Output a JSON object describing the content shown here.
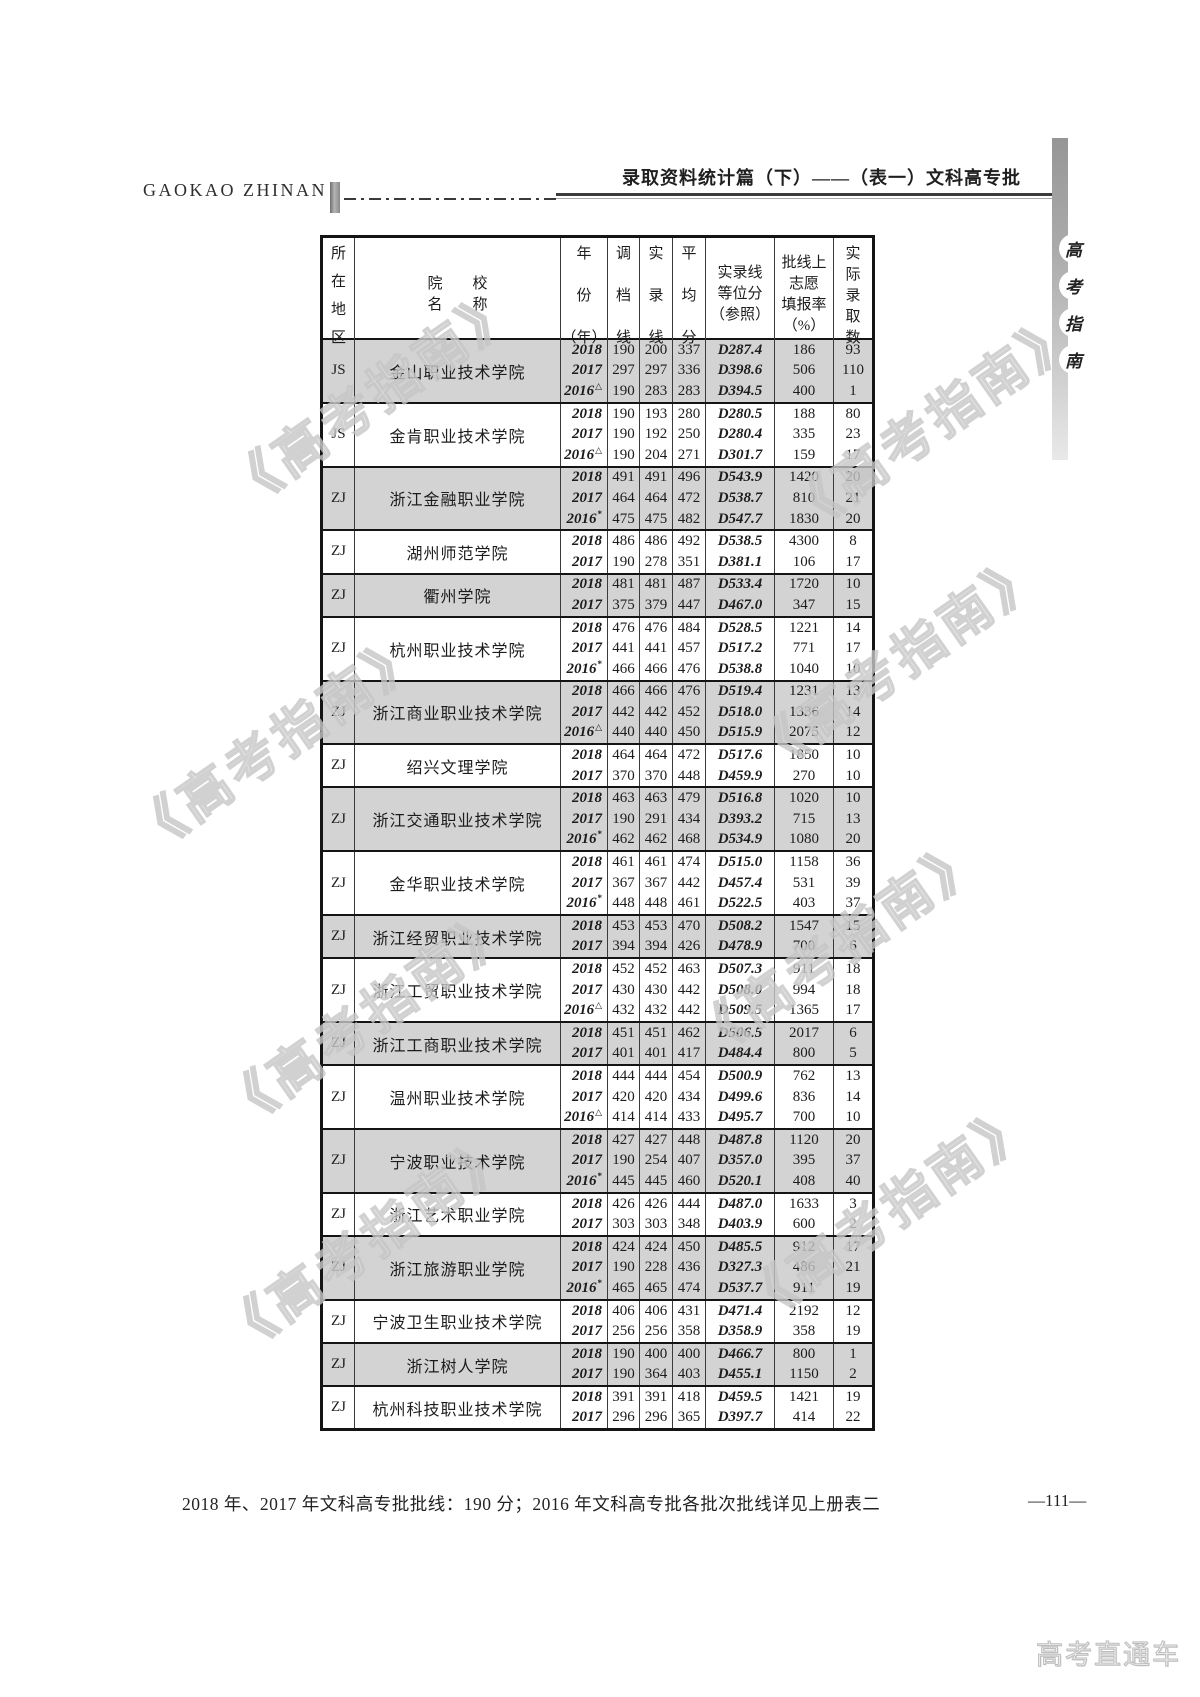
{
  "page": {
    "brand": "GAOKAO ZHINAN",
    "header_title": "录取资料统计篇（下）——（表一）文科高专批",
    "sidebar_label_chars": [
      "高",
      "考",
      "指",
      "南"
    ],
    "watermark_text": "《高考指南》",
    "footer_note": "2018 年、2017 年文科高专批批线：190 分；2016 年文科高专批各批次批线详见上册表二",
    "page_number": "—111—",
    "corner_watermark": "高考直通车"
  },
  "colors": {
    "row_shade": "#d3d3d3",
    "ink": "#1c1c1c",
    "watermark": "#c6c6c6"
  },
  "table": {
    "header": {
      "region_lines": [
        "所",
        "在",
        "地",
        "区"
      ],
      "college_lines": [
        "院　　校",
        "名　　称"
      ],
      "year_lines": [
        "年",
        "份",
        "（年）"
      ],
      "diaodang_lines": [
        "调",
        "档",
        "线"
      ],
      "shilu_lines": [
        "实",
        "录",
        "线"
      ],
      "pingjun_lines": [
        "平",
        "均",
        "分"
      ],
      "dengwei_lines": [
        "实录线",
        "等位分",
        "（参照）"
      ],
      "tianbao_lines": [
        "批线上",
        "志愿",
        "填报率",
        "（%）"
      ],
      "luqu_lines": [
        "实",
        "际",
        "录",
        "取",
        "数"
      ]
    },
    "groups": [
      {
        "region": "JS",
        "college": "金山职业技术学院",
        "shaded": true,
        "rows": [
          {
            "year": "2018",
            "sup": "",
            "diaodang": "190",
            "shilu": "200",
            "pingjun": "337",
            "dengwei": "D287.4",
            "tianbao": "186",
            "luqu": "93"
          },
          {
            "year": "2017",
            "sup": "",
            "diaodang": "297",
            "shilu": "297",
            "pingjun": "336",
            "dengwei": "D398.6",
            "tianbao": "506",
            "luqu": "110"
          },
          {
            "year": "2016",
            "sup": "△",
            "diaodang": "190",
            "shilu": "283",
            "pingjun": "283",
            "dengwei": "D394.5",
            "tianbao": "400",
            "luqu": "1"
          }
        ]
      },
      {
        "region": "JS",
        "college": "金肯职业技术学院",
        "shaded": false,
        "rows": [
          {
            "year": "2018",
            "sup": "",
            "diaodang": "190",
            "shilu": "193",
            "pingjun": "280",
            "dengwei": "D280.5",
            "tianbao": "188",
            "luqu": "80"
          },
          {
            "year": "2017",
            "sup": "",
            "diaodang": "190",
            "shilu": "192",
            "pingjun": "250",
            "dengwei": "D280.4",
            "tianbao": "335",
            "luqu": "23"
          },
          {
            "year": "2016",
            "sup": "△",
            "diaodang": "190",
            "shilu": "204",
            "pingjun": "271",
            "dengwei": "D301.7",
            "tianbao": "159",
            "luqu": "17"
          }
        ]
      },
      {
        "region": "ZJ",
        "college": "浙江金融职业学院",
        "shaded": true,
        "rows": [
          {
            "year": "2018",
            "sup": "",
            "diaodang": "491",
            "shilu": "491",
            "pingjun": "496",
            "dengwei": "D543.9",
            "tianbao": "1420",
            "luqu": "20"
          },
          {
            "year": "2017",
            "sup": "",
            "diaodang": "464",
            "shilu": "464",
            "pingjun": "472",
            "dengwei": "D538.7",
            "tianbao": "810",
            "luqu": "21"
          },
          {
            "year": "2016",
            "sup": "*",
            "diaodang": "475",
            "shilu": "475",
            "pingjun": "482",
            "dengwei": "D547.7",
            "tianbao": "1830",
            "luqu": "20"
          }
        ]
      },
      {
        "region": "ZJ",
        "college": "湖州师范学院",
        "shaded": false,
        "rows": [
          {
            "year": "2018",
            "sup": "",
            "diaodang": "486",
            "shilu": "486",
            "pingjun": "492",
            "dengwei": "D538.5",
            "tianbao": "4300",
            "luqu": "8"
          },
          {
            "year": "2017",
            "sup": "",
            "diaodang": "190",
            "shilu": "278",
            "pingjun": "351",
            "dengwei": "D381.1",
            "tianbao": "106",
            "luqu": "17"
          }
        ]
      },
      {
        "region": "ZJ",
        "college": "衢州学院",
        "shaded": true,
        "rows": [
          {
            "year": "2018",
            "sup": "",
            "diaodang": "481",
            "shilu": "481",
            "pingjun": "487",
            "dengwei": "D533.4",
            "tianbao": "1720",
            "luqu": "10"
          },
          {
            "year": "2017",
            "sup": "",
            "diaodang": "375",
            "shilu": "379",
            "pingjun": "447",
            "dengwei": "D467.0",
            "tianbao": "347",
            "luqu": "15"
          }
        ]
      },
      {
        "region": "ZJ",
        "college": "杭州职业技术学院",
        "shaded": false,
        "rows": [
          {
            "year": "2018",
            "sup": "",
            "diaodang": "476",
            "shilu": "476",
            "pingjun": "484",
            "dengwei": "D528.5",
            "tianbao": "1221",
            "luqu": "14"
          },
          {
            "year": "2017",
            "sup": "",
            "diaodang": "441",
            "shilu": "441",
            "pingjun": "457",
            "dengwei": "D517.2",
            "tianbao": "771",
            "luqu": "17"
          },
          {
            "year": "2016",
            "sup": "*",
            "diaodang": "466",
            "shilu": "466",
            "pingjun": "476",
            "dengwei": "D538.8",
            "tianbao": "1040",
            "luqu": "10"
          }
        ]
      },
      {
        "region": "ZJ",
        "college": "浙江商业职业技术学院",
        "shaded": true,
        "rows": [
          {
            "year": "2018",
            "sup": "",
            "diaodang": "466",
            "shilu": "466",
            "pingjun": "476",
            "dengwei": "D519.4",
            "tianbao": "1231",
            "luqu": "13"
          },
          {
            "year": "2017",
            "sup": "",
            "diaodang": "442",
            "shilu": "442",
            "pingjun": "452",
            "dengwei": "D518.0",
            "tianbao": "1336",
            "luqu": "14"
          },
          {
            "year": "2016",
            "sup": "△",
            "diaodang": "440",
            "shilu": "440",
            "pingjun": "450",
            "dengwei": "D515.9",
            "tianbao": "2075",
            "luqu": "12"
          }
        ]
      },
      {
        "region": "ZJ",
        "college": "绍兴文理学院",
        "shaded": false,
        "rows": [
          {
            "year": "2018",
            "sup": "",
            "diaodang": "464",
            "shilu": "464",
            "pingjun": "472",
            "dengwei": "D517.6",
            "tianbao": "1850",
            "luqu": "10"
          },
          {
            "year": "2017",
            "sup": "",
            "diaodang": "370",
            "shilu": "370",
            "pingjun": "448",
            "dengwei": "D459.9",
            "tianbao": "270",
            "luqu": "10"
          }
        ]
      },
      {
        "region": "ZJ",
        "college": "浙江交通职业技术学院",
        "shaded": true,
        "rows": [
          {
            "year": "2018",
            "sup": "",
            "diaodang": "463",
            "shilu": "463",
            "pingjun": "479",
            "dengwei": "D516.8",
            "tianbao": "1020",
            "luqu": "10"
          },
          {
            "year": "2017",
            "sup": "",
            "diaodang": "190",
            "shilu": "291",
            "pingjun": "434",
            "dengwei": "D393.2",
            "tianbao": "715",
            "luqu": "13"
          },
          {
            "year": "2016",
            "sup": "*",
            "diaodang": "462",
            "shilu": "462",
            "pingjun": "468",
            "dengwei": "D534.9",
            "tianbao": "1080",
            "luqu": "20"
          }
        ]
      },
      {
        "region": "ZJ",
        "college": "金华职业技术学院",
        "shaded": false,
        "rows": [
          {
            "year": "2018",
            "sup": "",
            "diaodang": "461",
            "shilu": "461",
            "pingjun": "474",
            "dengwei": "D515.0",
            "tianbao": "1158",
            "luqu": "36"
          },
          {
            "year": "2017",
            "sup": "",
            "diaodang": "367",
            "shilu": "367",
            "pingjun": "442",
            "dengwei": "D457.4",
            "tianbao": "531",
            "luqu": "39"
          },
          {
            "year": "2016",
            "sup": "*",
            "diaodang": "448",
            "shilu": "448",
            "pingjun": "461",
            "dengwei": "D522.5",
            "tianbao": "403",
            "luqu": "37"
          }
        ]
      },
      {
        "region": "ZJ",
        "college": "浙江经贸职业技术学院",
        "shaded": true,
        "rows": [
          {
            "year": "2018",
            "sup": "",
            "diaodang": "453",
            "shilu": "453",
            "pingjun": "470",
            "dengwei": "D508.2",
            "tianbao": "1547",
            "luqu": "15"
          },
          {
            "year": "2017",
            "sup": "",
            "diaodang": "394",
            "shilu": "394",
            "pingjun": "426",
            "dengwei": "D478.9",
            "tianbao": "700",
            "luqu": "6"
          }
        ]
      },
      {
        "region": "ZJ",
        "college": "浙江工贸职业技术学院",
        "shaded": false,
        "rows": [
          {
            "year": "2018",
            "sup": "",
            "diaodang": "452",
            "shilu": "452",
            "pingjun": "463",
            "dengwei": "D507.3",
            "tianbao": "911",
            "luqu": "18"
          },
          {
            "year": "2017",
            "sup": "",
            "diaodang": "430",
            "shilu": "430",
            "pingjun": "442",
            "dengwei": "D508.0",
            "tianbao": "994",
            "luqu": "18"
          },
          {
            "year": "2016",
            "sup": "△",
            "diaodang": "432",
            "shilu": "432",
            "pingjun": "442",
            "dengwei": "D509.5",
            "tianbao": "1365",
            "luqu": "17"
          }
        ]
      },
      {
        "region": "ZJ",
        "college": "浙江工商职业技术学院",
        "shaded": true,
        "rows": [
          {
            "year": "2018",
            "sup": "",
            "diaodang": "451",
            "shilu": "451",
            "pingjun": "462",
            "dengwei": "D506.5",
            "tianbao": "2017",
            "luqu": "6"
          },
          {
            "year": "2017",
            "sup": "",
            "diaodang": "401",
            "shilu": "401",
            "pingjun": "417",
            "dengwei": "D484.4",
            "tianbao": "800",
            "luqu": "5"
          }
        ]
      },
      {
        "region": "ZJ",
        "college": "温州职业技术学院",
        "shaded": false,
        "rows": [
          {
            "year": "2018",
            "sup": "",
            "diaodang": "444",
            "shilu": "444",
            "pingjun": "454",
            "dengwei": "D500.9",
            "tianbao": "762",
            "luqu": "13"
          },
          {
            "year": "2017",
            "sup": "",
            "diaodang": "420",
            "shilu": "420",
            "pingjun": "434",
            "dengwei": "D499.6",
            "tianbao": "836",
            "luqu": "14"
          },
          {
            "year": "2016",
            "sup": "△",
            "diaodang": "414",
            "shilu": "414",
            "pingjun": "433",
            "dengwei": "D495.7",
            "tianbao": "700",
            "luqu": "10"
          }
        ]
      },
      {
        "region": "ZJ",
        "college": "宁波职业技术学院",
        "shaded": true,
        "rows": [
          {
            "year": "2018",
            "sup": "",
            "diaodang": "427",
            "shilu": "427",
            "pingjun": "448",
            "dengwei": "D487.8",
            "tianbao": "1120",
            "luqu": "20"
          },
          {
            "year": "2017",
            "sup": "",
            "diaodang": "190",
            "shilu": "254",
            "pingjun": "407",
            "dengwei": "D357.0",
            "tianbao": "395",
            "luqu": "37"
          },
          {
            "year": "2016",
            "sup": "*",
            "diaodang": "445",
            "shilu": "445",
            "pingjun": "460",
            "dengwei": "D520.1",
            "tianbao": "408",
            "luqu": "40"
          }
        ]
      },
      {
        "region": "ZJ",
        "college": "浙江艺术职业学院",
        "shaded": false,
        "rows": [
          {
            "year": "2018",
            "sup": "",
            "diaodang": "426",
            "shilu": "426",
            "pingjun": "444",
            "dengwei": "D487.0",
            "tianbao": "1633",
            "luqu": "3"
          },
          {
            "year": "2017",
            "sup": "",
            "diaodang": "303",
            "shilu": "303",
            "pingjun": "348",
            "dengwei": "D403.9",
            "tianbao": "600",
            "luqu": "2"
          }
        ]
      },
      {
        "region": "ZJ",
        "college": "浙江旅游职业学院",
        "shaded": true,
        "rows": [
          {
            "year": "2018",
            "sup": "",
            "diaodang": "424",
            "shilu": "424",
            "pingjun": "450",
            "dengwei": "D485.5",
            "tianbao": "912",
            "luqu": "17"
          },
          {
            "year": "2017",
            "sup": "",
            "diaodang": "190",
            "shilu": "228",
            "pingjun": "436",
            "dengwei": "D327.3",
            "tianbao": "486",
            "luqu": "21"
          },
          {
            "year": "2016",
            "sup": "*",
            "diaodang": "465",
            "shilu": "465",
            "pingjun": "474",
            "dengwei": "D537.7",
            "tianbao": "911",
            "luqu": "19"
          }
        ]
      },
      {
        "region": "ZJ",
        "college": "宁波卫生职业技术学院",
        "shaded": false,
        "rows": [
          {
            "year": "2018",
            "sup": "",
            "diaodang": "406",
            "shilu": "406",
            "pingjun": "431",
            "dengwei": "D471.4",
            "tianbao": "2192",
            "luqu": "12"
          },
          {
            "year": "2017",
            "sup": "",
            "diaodang": "256",
            "shilu": "256",
            "pingjun": "358",
            "dengwei": "D358.9",
            "tianbao": "358",
            "luqu": "19"
          }
        ]
      },
      {
        "region": "ZJ",
        "college": "浙江树人学院",
        "shaded": true,
        "rows": [
          {
            "year": "2018",
            "sup": "",
            "diaodang": "190",
            "shilu": "400",
            "pingjun": "400",
            "dengwei": "D466.7",
            "tianbao": "800",
            "luqu": "1"
          },
          {
            "year": "2017",
            "sup": "",
            "diaodang": "190",
            "shilu": "364",
            "pingjun": "403",
            "dengwei": "D455.1",
            "tianbao": "1150",
            "luqu": "2"
          }
        ]
      },
      {
        "region": "ZJ",
        "college": "杭州科技职业技术学院",
        "shaded": false,
        "rows": [
          {
            "year": "2018",
            "sup": "",
            "diaodang": "391",
            "shilu": "391",
            "pingjun": "418",
            "dengwei": "D459.5",
            "tianbao": "1421",
            "luqu": "19"
          },
          {
            "year": "2017",
            "sup": "",
            "diaodang": "296",
            "shilu": "296",
            "pingjun": "365",
            "dengwei": "D397.7",
            "tianbao": "414",
            "luqu": "22"
          }
        ]
      }
    ]
  }
}
